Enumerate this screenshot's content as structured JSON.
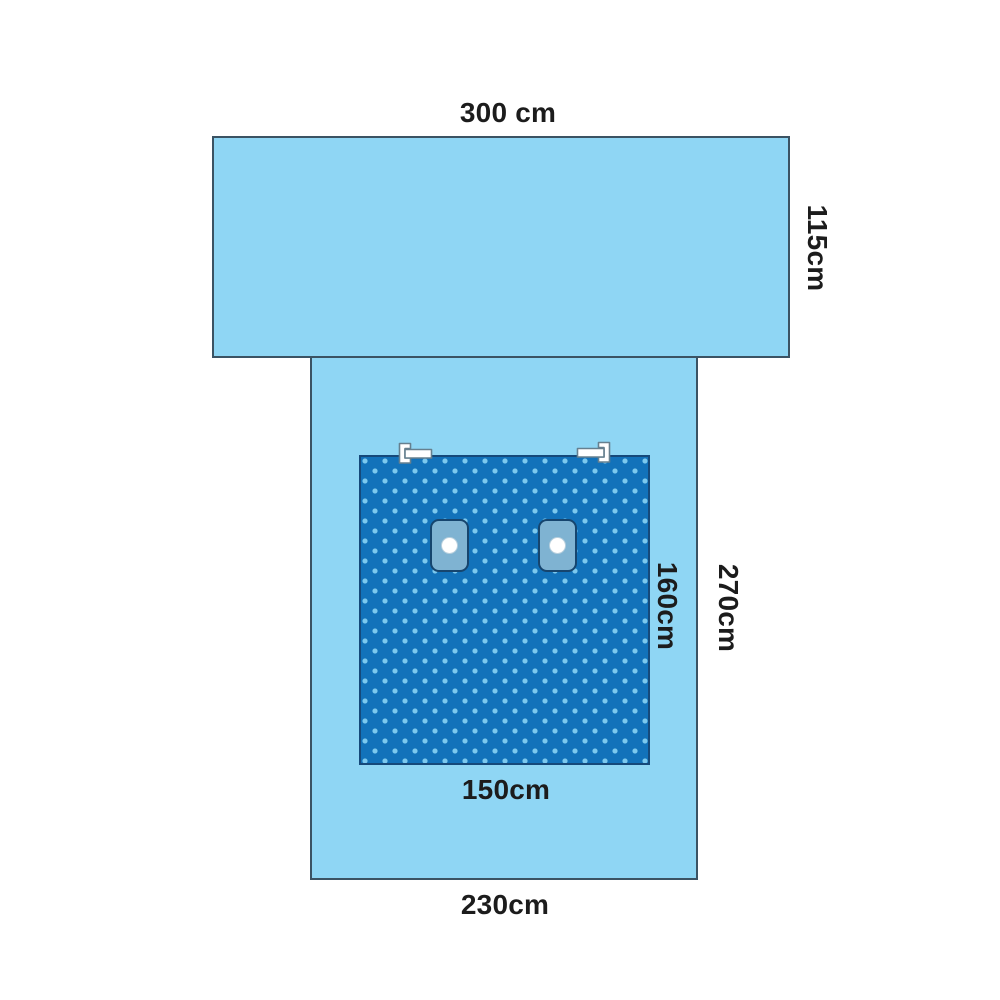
{
  "labels": {
    "top_width": "300 cm",
    "top_panel_height": "115cm",
    "fenestration_height": "160cm",
    "lower_panel_height": "270cm",
    "fenestration_width": "150cm",
    "lower_panel_width": "230cm"
  },
  "colors": {
    "background": "#ffffff",
    "drape_light": "#8FD6F4",
    "drape_border": "#3B5363",
    "pattern_blue": "#1272BA",
    "pattern_border": "#15497A",
    "dot_color": "#7CC9EE",
    "patch_fill": "#7FB3D2",
    "patch_border": "#16456E",
    "hole_fill": "#FFFFFF",
    "tab_fill": "#FFFFFF",
    "tab_border": "#66808F",
    "label_color": "#1C1C1C"
  }
}
